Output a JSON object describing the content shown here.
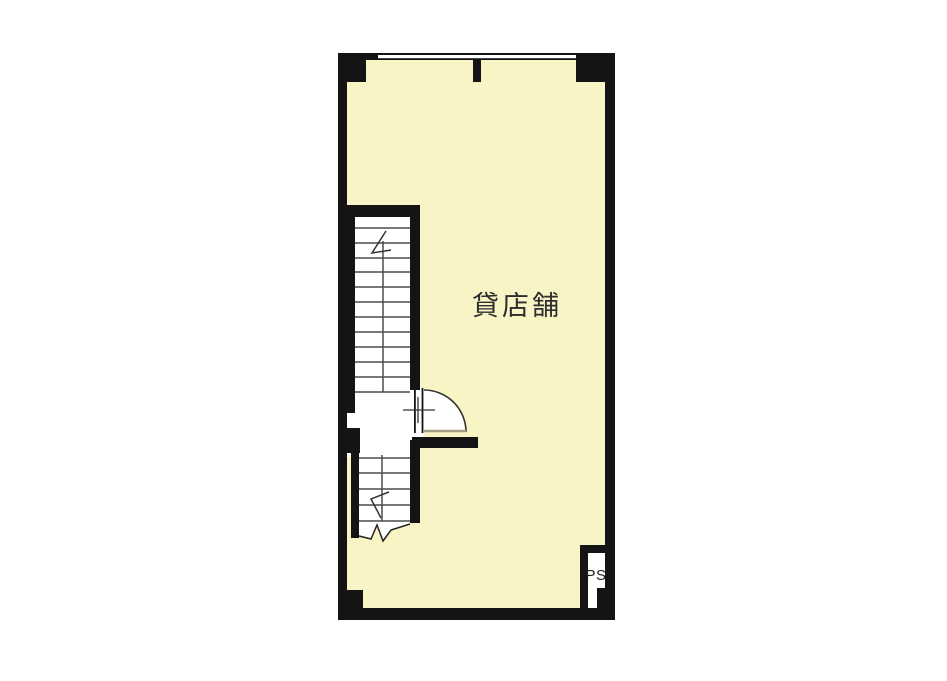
{
  "page": {
    "background": "#ffffff"
  },
  "floor_plan": {
    "room_label": "貸店舗",
    "shaft_label": "PS",
    "colors": {
      "floor": "#f8f4c6",
      "wall": "#141414",
      "stepline": "#4c4c4c",
      "detail": "#333333",
      "chord": "#a49e87",
      "text": "#2d2d2d"
    }
  }
}
